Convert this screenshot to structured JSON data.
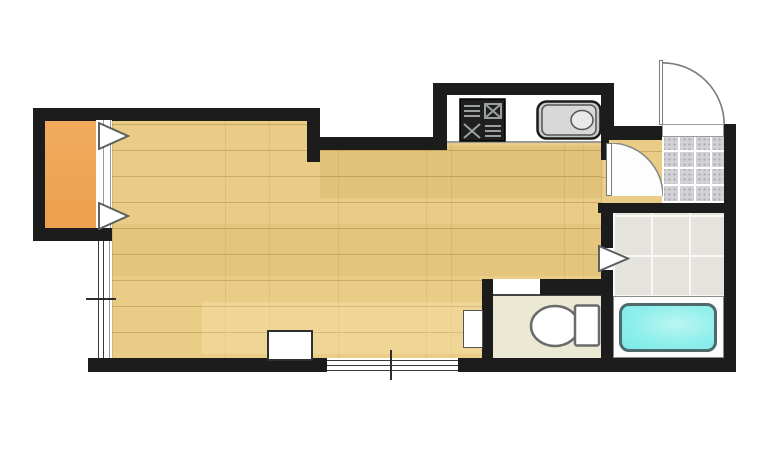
{
  "title": "studio-apartment-floor-plan",
  "colors": {
    "bg": "#ffffff",
    "wall": "#1c1c1c",
    "wood": "#e9cd87",
    "closet": "#eda04d",
    "genkan": "#d2d2d6",
    "washroom": "#e5e3de",
    "toilet": "#ebe8d3",
    "tub": "#8fefec",
    "tub-border": "#4e6a6c",
    "fixture-outline": "#6a6a6a",
    "door-line": "#7a7a7a"
  },
  "rooms": {
    "main_room": "wood-floor-room",
    "closet": "orange-closet",
    "kitchen": "kitchen-counter-nook",
    "entry": "tiled-genkan-entry",
    "washroom": "tiled-washroom",
    "bathroom": "bathtub-room",
    "toilet_room": "toilet-room"
  },
  "fixtures": {
    "stove": "stove-grill-icon",
    "sink": "kitchen-sink-icon",
    "toilet": "toilet-icon",
    "bathtub": "bathtub-icon",
    "entry_door": "door-swing-arc-icon",
    "interior_door": "door-swing-arc-icon",
    "closet_arrow_top": "triangle-arrow-icon",
    "closet_arrow_bottom": "triangle-arrow-icon",
    "washroom_arrow": "triangle-arrow-icon",
    "window_left": "double-line-window-icon",
    "window_bottom": "double-line-window-icon"
  }
}
